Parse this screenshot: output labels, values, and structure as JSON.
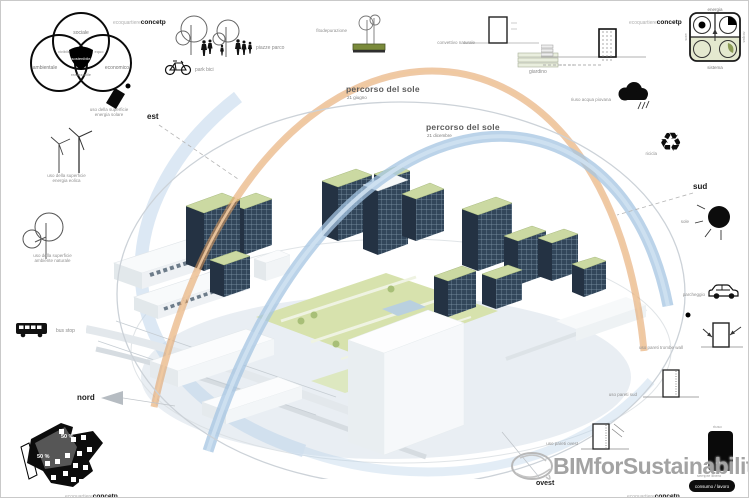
{
  "corner_labels": {
    "light": "ecoquartiere",
    "bold": "concetp"
  },
  "venn": {
    "top": "sociale",
    "left": "ambientale",
    "right": "economico",
    "overlap_left": "vivibile",
    "overlap_right": "equo",
    "center": "sostenibile",
    "overlap_bottom": "realizzabile"
  },
  "top_icons": {
    "park_label": "piazze parco",
    "bike_label": "park bici",
    "fito_label": "fitodepurazione",
    "convettivo_label": "convettivo naturale",
    "giardino_label": "giardino"
  },
  "energy_box": {
    "top": "energia",
    "bottom": "sistema",
    "left": "sole",
    "right": "acqua"
  },
  "left_icons": {
    "solar_line1": "uso della superficie",
    "solar_line2": "energia solare",
    "wind_line1": "uso della superficie",
    "wind_line2": "energia eolica",
    "tree_line1": "uso della superficie",
    "tree_line2": "ambiente naturale",
    "bus_label": "bus stop",
    "plan_pct_black": "50 %",
    "plan_pct_gray": "50 %"
  },
  "right_icons": {
    "rain_label": "riuso acqua piovana",
    "recycle_label": "ricicla",
    "recycle_glyph": "♻",
    "sun_label": "sole",
    "car_label": "parcheggio",
    "trombe_label": "uso pareti trombe wall",
    "south_label": "uso pareti sud",
    "west_label": "uso pareti ovest",
    "mass_top_label": "riuso",
    "mass_inner_label": "calore",
    "footer_note": "sempre libero",
    "footer_pill": "consumo / lavoro"
  },
  "compass": {
    "est": "est",
    "sud": "sud",
    "nord": "nord",
    "ovest": "ovest"
  },
  "sun_paths": {
    "summer_label": "percorso del sole",
    "summer_sub": "21 giugno",
    "winter_label": "percorso del sole",
    "winter_sub": "21 dicembre"
  },
  "watermark": {
    "text": "BIMforSustainability"
  },
  "colors": {
    "summer_arc": "#e29c5d",
    "winter_arc": "#a4c4e1",
    "roof_green": "#cbd9a2",
    "facade_blue": "#32465a",
    "courtyard_green": "#d7e2ad"
  }
}
